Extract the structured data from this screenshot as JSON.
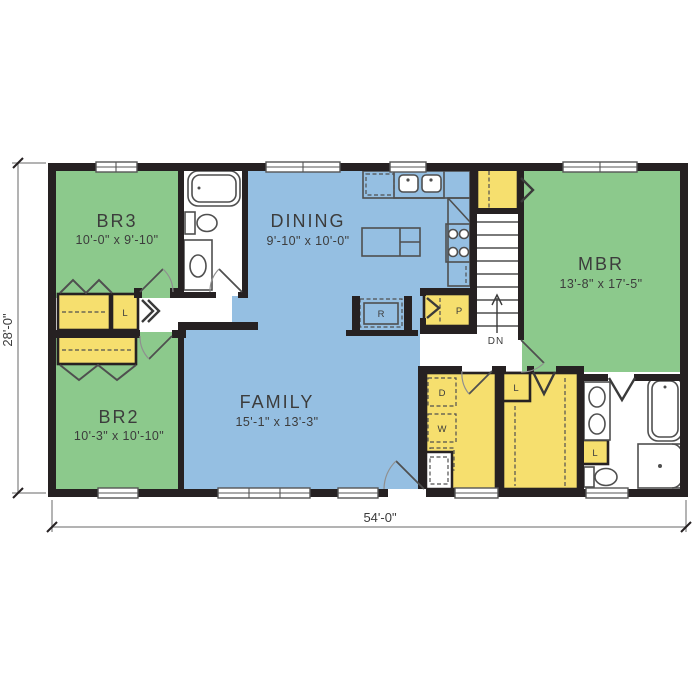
{
  "plan": {
    "dimensions": {
      "width": "54'-0\"",
      "depth": "28'-0\""
    },
    "rooms": [
      {
        "name": "BR3",
        "dims": "10'-0\" x 9'-10\""
      },
      {
        "name": "DINING",
        "dims": "9'-10\" x 10'-0\""
      },
      {
        "name": "MBR",
        "dims": "13'-8\" x 17'-5\""
      },
      {
        "name": "BR2",
        "dims": "10'-3\" x 10'-10\""
      },
      {
        "name": "FAMILY",
        "dims": "15'-1\" x 13'-3\""
      }
    ],
    "markers": {
      "hall_linen": "L",
      "walkin_linen": "L",
      "bath_linen": "L",
      "pantry": "P",
      "refrigerator": "R",
      "dryer": "D",
      "washer": "W",
      "stairs_down": "DN"
    },
    "colors": {
      "bedroom": "#8cc98c",
      "living": "#95bfe2",
      "closet": "#f6df6e",
      "wall": "#262122",
      "dimension": "#9a9a9a"
    },
    "fixtures": [
      "bathtub",
      "toilet",
      "vanity-sink",
      "kitchen-sink",
      "range",
      "island",
      "refrigerator",
      "dryer",
      "washer",
      "double-vanity",
      "shower",
      "stairs"
    ]
  }
}
